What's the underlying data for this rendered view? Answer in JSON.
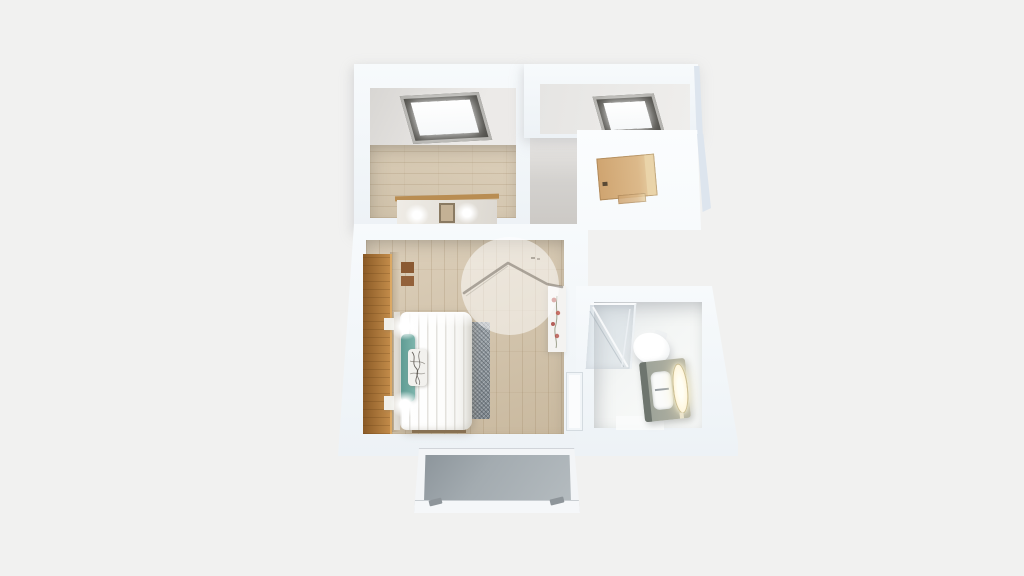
{
  "app": {
    "name": "3d-floorplan-render",
    "description": "Top-down 3D rendered floor plan of an attic apartment on a plain light background. No text labels are rendered.",
    "watermark": {
      "shape": "translucent-circle",
      "icon": "house-roof-icon"
    }
  },
  "scene": {
    "view": "bird-eye-3d",
    "rooms": [
      {
        "name": "attic-room",
        "floor": "wood",
        "objects": [
          "skylight",
          "mirror-dresser-with-lights"
        ]
      },
      {
        "name": "hallway",
        "floor": "none-visible",
        "objects": [
          "skylight",
          "wood-entry-door-on-dormer"
        ]
      },
      {
        "name": "bedroom",
        "floor": "wood",
        "objects": [
          "tall-wood-wardrobe",
          "double-bed-white-duvet",
          "teal-pillows",
          "patterned-cushion",
          "bedside-lamps-lit",
          "gray-foot-rug",
          "flower-decor-panel",
          "door-to-bathroom",
          "wall-decor-squares"
        ]
      },
      {
        "name": "bathroom",
        "floor": "white-tile",
        "objects": [
          "corner-glass-shower",
          "toilet",
          "vanity-with-lit-mirror",
          "sink-basin"
        ]
      },
      {
        "name": "balcony",
        "floor": "concrete",
        "objects": [
          "white-railing-frame",
          "railing-feet"
        ]
      }
    ]
  },
  "colors": {
    "bg": "#f1f1f0",
    "wall_light": "#f7fafc",
    "wall_mid": "#edf2f6",
    "wall_shade": "#dde5ee",
    "ceiling_light": "#eceae8",
    "ceiling_dark": "#d8d6d3",
    "hall_wall": "#d3d1ce",
    "wood_light": "#dccfba",
    "wood_dark": "#c9b99f",
    "wardrobe_dark": "#8a5a26",
    "wardrobe_light": "#c28b49",
    "door_wood": "#cfa470",
    "door_wood_light": "#ead5ab",
    "skylight_frame": "#4f4e49",
    "skylight_rim": "#b3b2ae",
    "glass_white": "#f6f8f9",
    "duvet_white": "#fdfdfc",
    "pillow_teal": "#7db5ac",
    "pillow_teal_dark": "#5f9b93",
    "cushion_print": "#4a453e",
    "rug_gray": "#98a0a6",
    "rug_dark": "#7c858c",
    "balcony_floor": "#a3abb0",
    "balcony_frame": "#f3f5f7",
    "vanity_cabinet": "#9aa198",
    "vanity_dark": "#6e756e",
    "mirror_glow": "#fff6dc",
    "mirror_rim": "#cfc194",
    "toilet_white": "#ffffff",
    "flower_red": "#b14a42",
    "stem_green": "#8a8d76",
    "watermark_line": "#6a6257"
  }
}
